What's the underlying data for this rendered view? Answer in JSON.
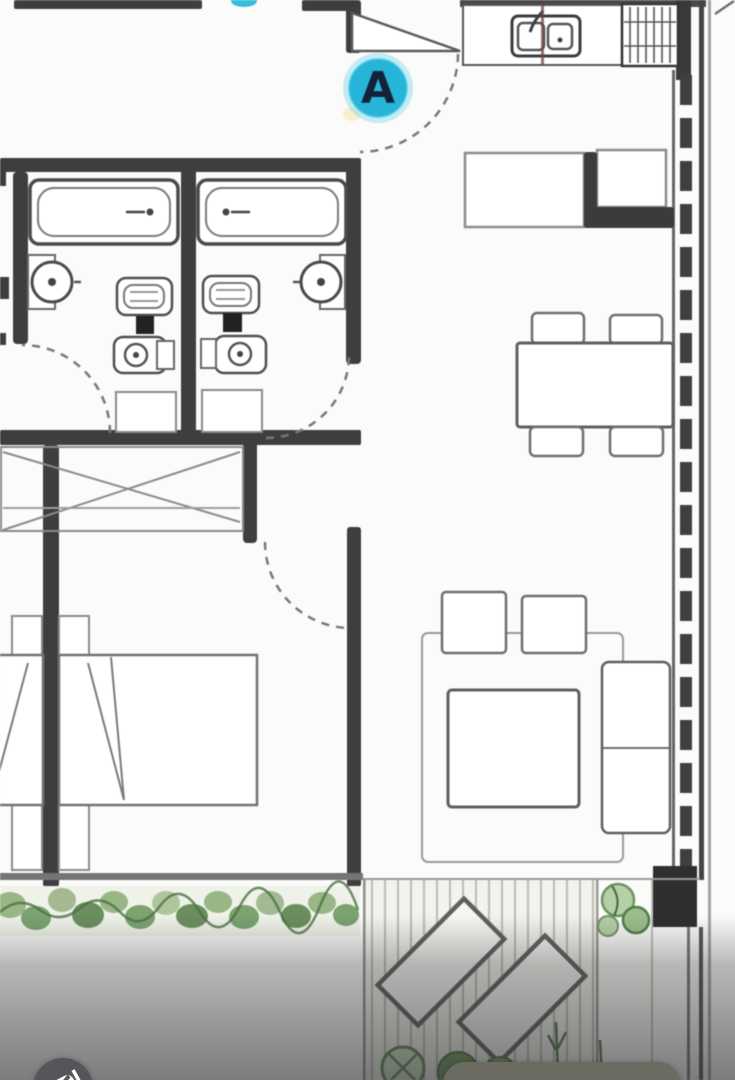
{
  "screen": {
    "width": 735,
    "height": 1080
  },
  "marker": {
    "label": "A",
    "fill": "#27b4d9",
    "halo": "#7dd6ec",
    "text_color": "#132238"
  },
  "secondary_marker": {
    "label": "",
    "note": "cut off at top edge",
    "fill": "#36bedd"
  },
  "floorplan": {
    "wall_color": "#3e3e3e",
    "furniture_line_color": "#6f6f6f",
    "deck_color": "#f2f2ee",
    "greenery_colors": [
      "#8fb07c",
      "#6f9a63",
      "#5c8450"
    ],
    "rooms": [
      {
        "name": "bathroom-1",
        "fixtures": [
          "bathtub",
          "washbasin",
          "toilet",
          "bidet",
          "door-swing",
          "mat"
        ]
      },
      {
        "name": "bathroom-2",
        "fixtures": [
          "bathtub",
          "washbasin",
          "toilet",
          "bidet",
          "door-swing",
          "mat"
        ]
      },
      {
        "name": "entry-hall",
        "fixtures": [
          "entry-door-swing"
        ]
      },
      {
        "name": "kitchen",
        "fixtures": [
          "counter",
          "double-sink",
          "cooktop",
          "peninsula-counter"
        ]
      },
      {
        "name": "dining-area",
        "fixtures": [
          "dining-table",
          "chair",
          "chair",
          "chair",
          "chair"
        ]
      },
      {
        "name": "living-area",
        "fixtures": [
          "rug",
          "armchair",
          "armchair",
          "coffee-table",
          "sofa"
        ]
      },
      {
        "name": "bedroom",
        "fixtures": [
          "wardrobe",
          "double-bed",
          "door-swing"
        ]
      },
      {
        "name": "adjacent-bedroom-cut",
        "fixtures": [
          "double-bed-partial"
        ]
      },
      {
        "name": "terrace",
        "fixtures": [
          "deck-boards",
          "lounge-chair",
          "lounge-chair",
          "plants"
        ]
      },
      {
        "name": "garden-strip",
        "fixtures": [
          "hedge-planting"
        ]
      }
    ],
    "window_wall": "dashed glazing band along right facade"
  },
  "overlay": {
    "scrim_color": "#2e2e2e",
    "watermark_badge": {
      "shape": "circle",
      "color": "#55565a",
      "glyph": "brand logo, partially visible"
    },
    "bottom_pill": {
      "color": "#6b6b62",
      "label": ""
    }
  }
}
